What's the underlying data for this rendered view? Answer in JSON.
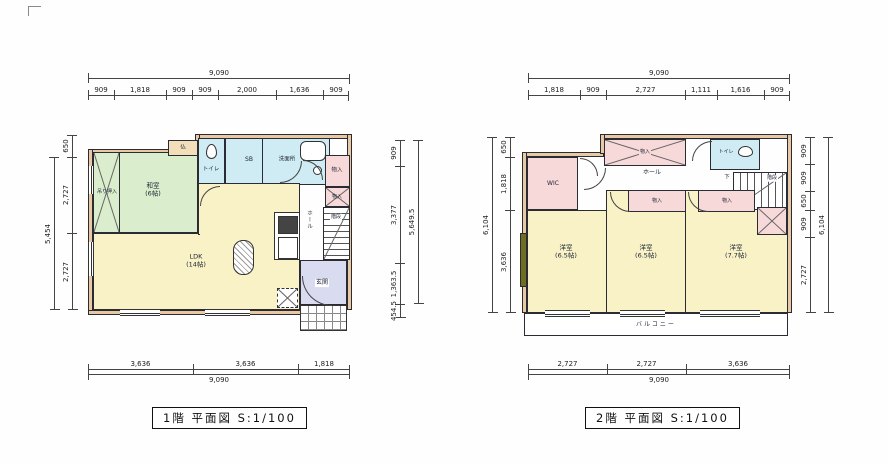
{
  "sheet": {
    "floor1_title": "1階 平面図 S:1/100",
    "floor2_title": "2階 平面図 S:1/100"
  },
  "colors": {
    "wall_tan": "#e9c9a3",
    "room_yellow": "#f8f2c6",
    "room_green": "#daeecd",
    "room_blue": "#cfebf3",
    "room_pink": "#f8d9da",
    "room_lavender": "#d9dbf1",
    "line_dark": "#2b2b33",
    "window_olive": "#6e6e20"
  },
  "floor1": {
    "dims": {
      "top": {
        "total": "9,090",
        "segments": [
          "909",
          "1,818",
          "909",
          "909",
          "2,000",
          "1,636",
          "909"
        ]
      },
      "bottom": {
        "total": "9,090",
        "segments": [
          "3,636",
          "3,636",
          "1,818"
        ]
      },
      "left": {
        "total": "5,454",
        "segments": [
          "650",
          "2,727",
          "2,727"
        ]
      },
      "right": {
        "total": "5,649.5",
        "segments": [
          "909",
          "3,377",
          "1,363.5",
          "454.5"
        ]
      }
    },
    "labels": {
      "washitsu": "和室",
      "washitsu_size": "(6帖)",
      "tsurioshiire": "吊り押入",
      "butsudan": "仏",
      "toilet": "トイレ",
      "shoebox": "SB",
      "washroom": "洗面所",
      "storage1": "物入",
      "storage2": "物入",
      "hall": "ホール",
      "stairs": "階段",
      "ldk": "LDK",
      "ldk_size": "(14帖)",
      "genkan": "玄関"
    }
  },
  "floor2": {
    "dims": {
      "top": {
        "total": "9,090",
        "segments": [
          "1,818",
          "909",
          "2,727",
          "1,111",
          "1,616",
          "909"
        ]
      },
      "bottom": {
        "total": "9,090",
        "segments": [
          "2,727",
          "2,727",
          "3,636"
        ]
      },
      "left": {
        "total": "6,104",
        "segments": [
          "650",
          "1,818",
          "3,636"
        ]
      },
      "right": {
        "total": "6,104",
        "segments": [
          "909",
          "909",
          "650",
          "909",
          "2,727"
        ]
      }
    },
    "labels": {
      "wic": "WIC",
      "closet_top": "物入",
      "toilet": "トイレ",
      "stairs": "階段",
      "down": "下",
      "hall": "ホール",
      "closet2": "物入",
      "closet3": "物入",
      "room1": "洋室",
      "room1_size": "(6.5帖)",
      "room2": "洋室",
      "room2_size": "(6.5帖)",
      "room3": "洋室",
      "room3_size": "(7.7帖)",
      "balcony": "バルコニー"
    }
  }
}
